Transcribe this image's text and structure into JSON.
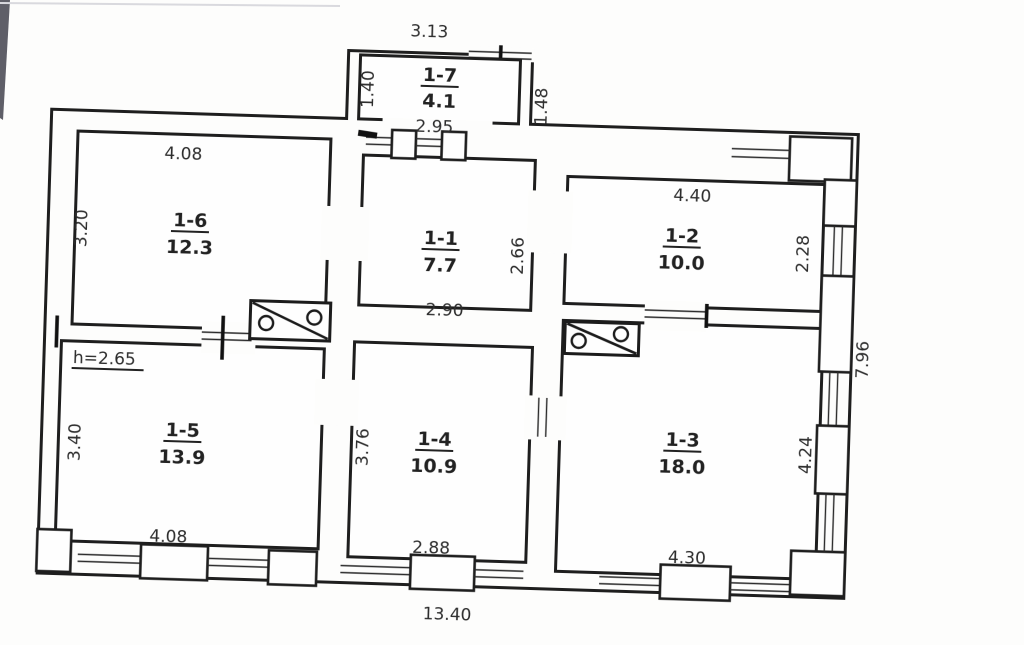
{
  "plan": {
    "title": "Apartment floor plan (technical inventory drawing)",
    "rooms": [
      {
        "id": "1-7",
        "area": "4.1",
        "dim_top": "3.13",
        "dim_left": "1.40",
        "dim_right": "1.48",
        "dim_bottom": "2.95"
      },
      {
        "id": "1-6",
        "area": "12.3",
        "dim_top": "4.08",
        "dim_left": "3.20"
      },
      {
        "id": "1-1",
        "area": "7.7",
        "dim_right": "2.66",
        "dim_bottom": "2.90"
      },
      {
        "id": "1-2",
        "area": "10.0",
        "dim_top": "4.40",
        "dim_right": "2.28"
      },
      {
        "id": "1-5",
        "area": "13.9",
        "dim_left": "3.40",
        "dim_bottom": "4.08",
        "height_note": "h=2.65"
      },
      {
        "id": "1-4",
        "area": "10.9",
        "dim_left": "3.76",
        "dim_bottom": "2.88"
      },
      {
        "id": "1-3",
        "area": "18.0",
        "dim_right": "4.24",
        "dim_bottom": "4.30"
      }
    ],
    "overall": {
      "width": "13.40",
      "height": "7.96"
    },
    "ink_color": "#1e1e1e",
    "text_color": "#2d2d2d"
  }
}
